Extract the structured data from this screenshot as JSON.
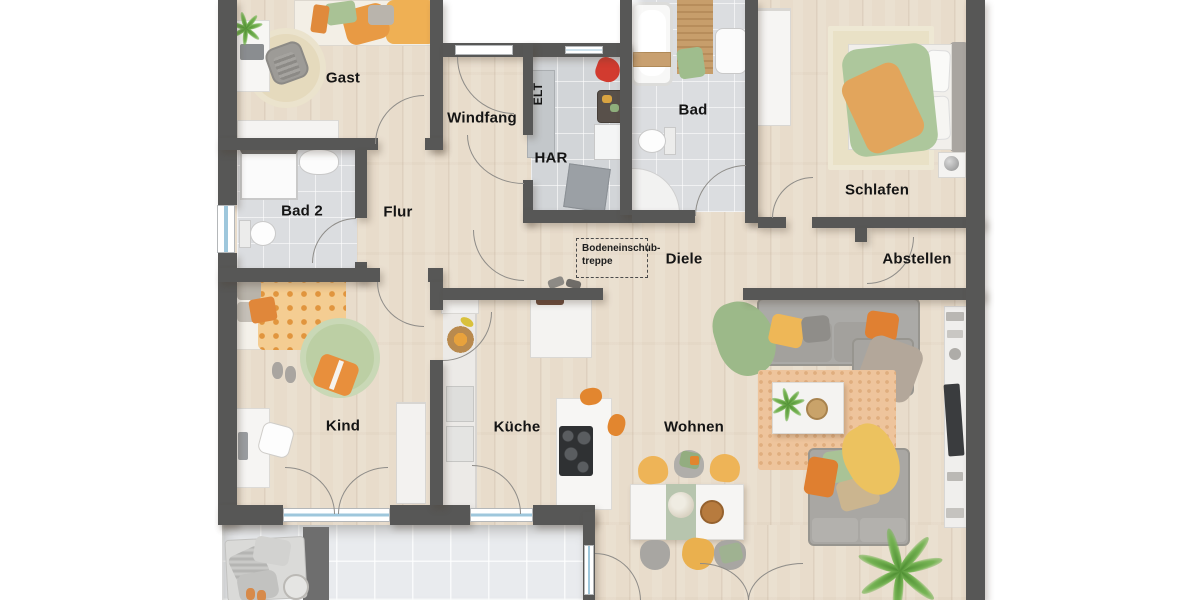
{
  "rooms": {
    "gast": "Gast",
    "windfang": "Windfang",
    "elt": "ELT",
    "har": "HAR",
    "bad": "Bad",
    "schlafen": "Schlafen",
    "bad2": "Bad 2",
    "flur": "Flur",
    "diele": "Diele",
    "abstellen": "Abstellen",
    "kind": "Kind",
    "kueche": "Küche",
    "wohnen": "Wohnen"
  },
  "annotations": {
    "attic_ladder_line1": "Bodeneinschub-",
    "attic_ladder_line2": "treppe"
  },
  "colors": {
    "wall": "#575756",
    "wood_floor": "#e8dccb",
    "bath_tile": "#dbdde0",
    "har_tile": "#d2d5d8",
    "terrace_tile": "#e9ebee",
    "background": "#ffffff",
    "window_glass": "#9ec7dc",
    "accent_orange": "#e2862f",
    "accent_yellow": "#eeb052",
    "accent_green": "#a3bd8f",
    "sofa_gray": "#a9a7a3"
  }
}
